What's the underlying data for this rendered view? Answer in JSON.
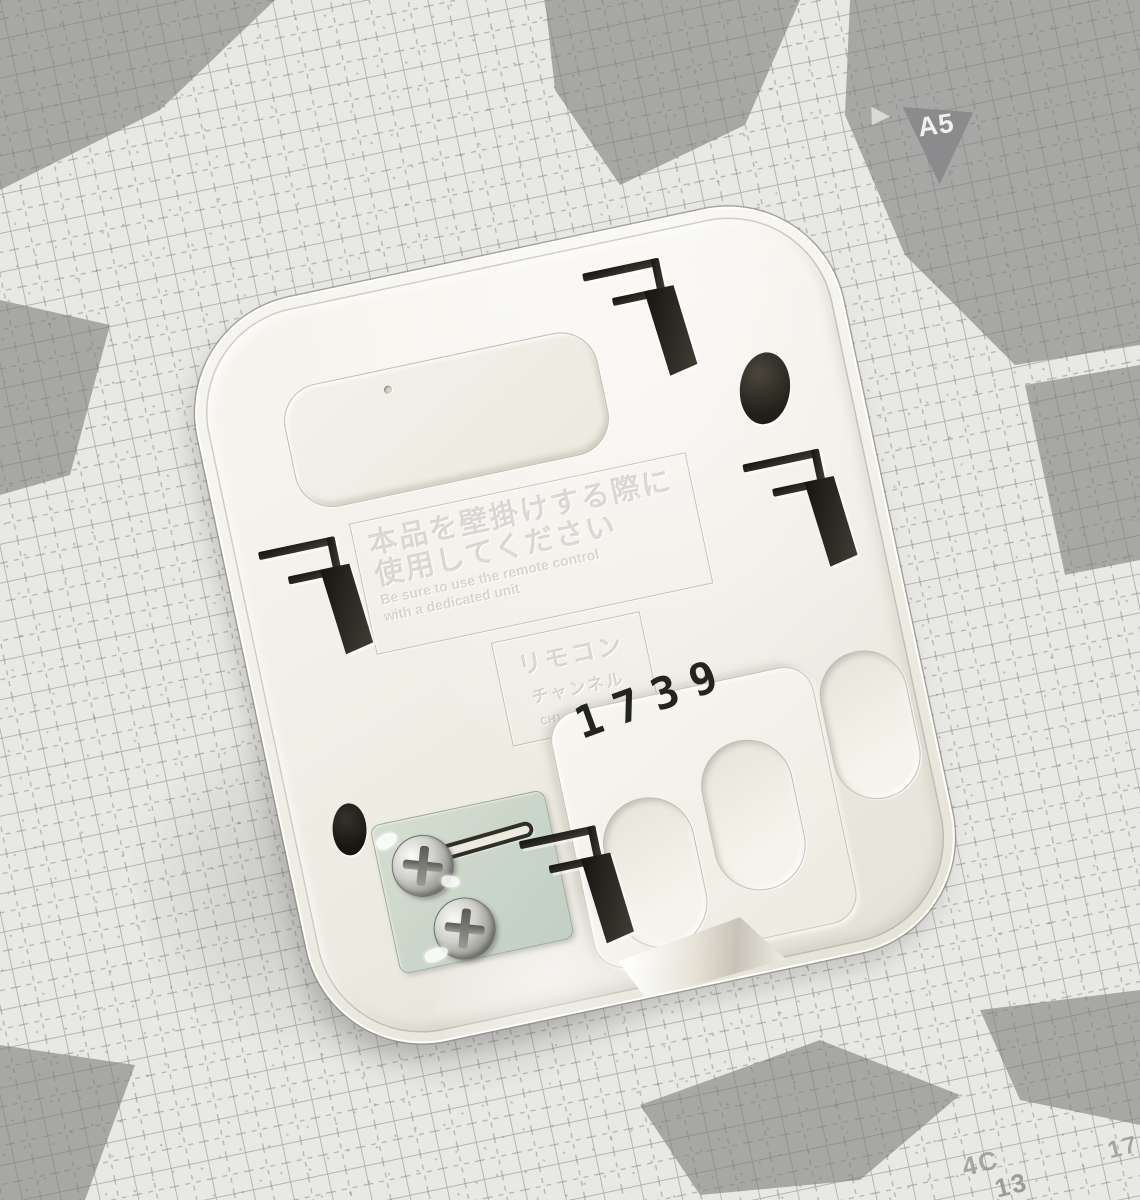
{
  "scene": {
    "type": "photograph",
    "subject": "Back side of a white plastic remote-control wall holder lying on a gray self-healing cutting mat"
  },
  "mat": {
    "marker_a5": "A5",
    "mark_4c": "4C",
    "mark_13": "13",
    "mark_17": "17"
  },
  "device": {
    "stamp": "1739",
    "panel_large": {
      "jp_line1": "本品を壁掛けする際に",
      "jp_line2": "使用してください",
      "en_line1": "Be sure to use the remote control",
      "en_line2": "with a dedicated unit"
    },
    "panel_small": {
      "line1": "リモコン",
      "line2": "チャンネル",
      "line3": "CH1・CH2・CH3"
    }
  },
  "colors": {
    "mat_base": "#e8e8e4",
    "mat_dark_patch": "#a7a7a5",
    "grid_line": "#7c7c78",
    "device_body": "#f2efe8",
    "terminal_plate_green": "#cdd8cb",
    "stamp_text": "#23231f",
    "a5_marker_bg": "#8b8b8e"
  }
}
